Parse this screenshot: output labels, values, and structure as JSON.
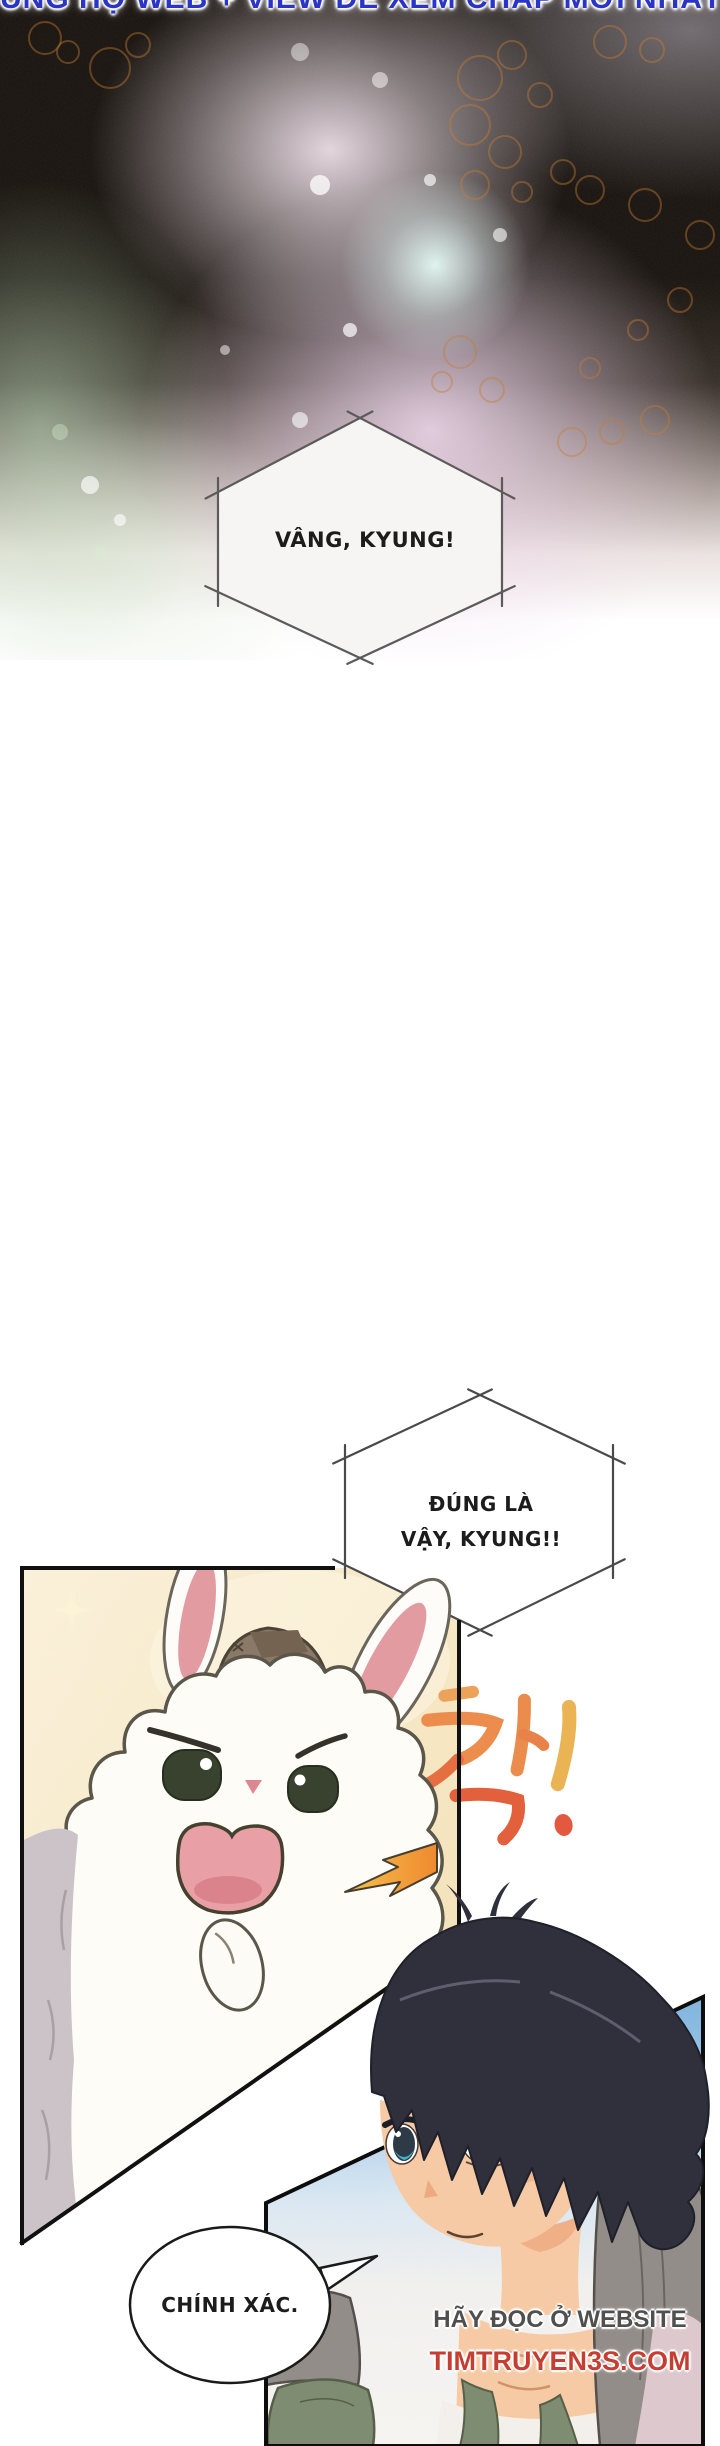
{
  "page": {
    "width": 720,
    "height": 2446
  },
  "banner": {
    "text": "ỦNG HỘ WEB + VIEW ĐỂ XEM CHAP MỚI NHẤT",
    "color": "#2a35c5"
  },
  "speech_bubbles": {
    "bubble1": {
      "shape": "hexagon",
      "text": "VÂNG, KYUNG!"
    },
    "bubble2": {
      "shape": "hexagon",
      "line1": "ĐÚNG LÀ",
      "line2": "VẬY, KYUNG!!"
    },
    "bubble3": {
      "shape": "ellipse",
      "text": "CHÍNH XÁC."
    }
  },
  "sfx": {
    "text": "착!",
    "color_top": "#f0a055",
    "color_bottom": "#e2603c"
  },
  "watermark": {
    "line1": "HÃY ĐỌC Ở WEBSITE",
    "line2": "TIMTRUYEN3S.COM",
    "line1_color": "#4f4f4f",
    "line2_color": "#c63d32"
  },
  "colors": {
    "panel_cream": "#f5e6c2",
    "sky_blue": "#84b7e1",
    "rabbit_ear_pink": "#e29ba1",
    "boy_hair_navy": "#31313d",
    "skin": "#f6caa4",
    "jacket_grey": "#938d89",
    "shirt_green": "#7e8c71",
    "bokeh_circle_orange": "#c5762d"
  }
}
